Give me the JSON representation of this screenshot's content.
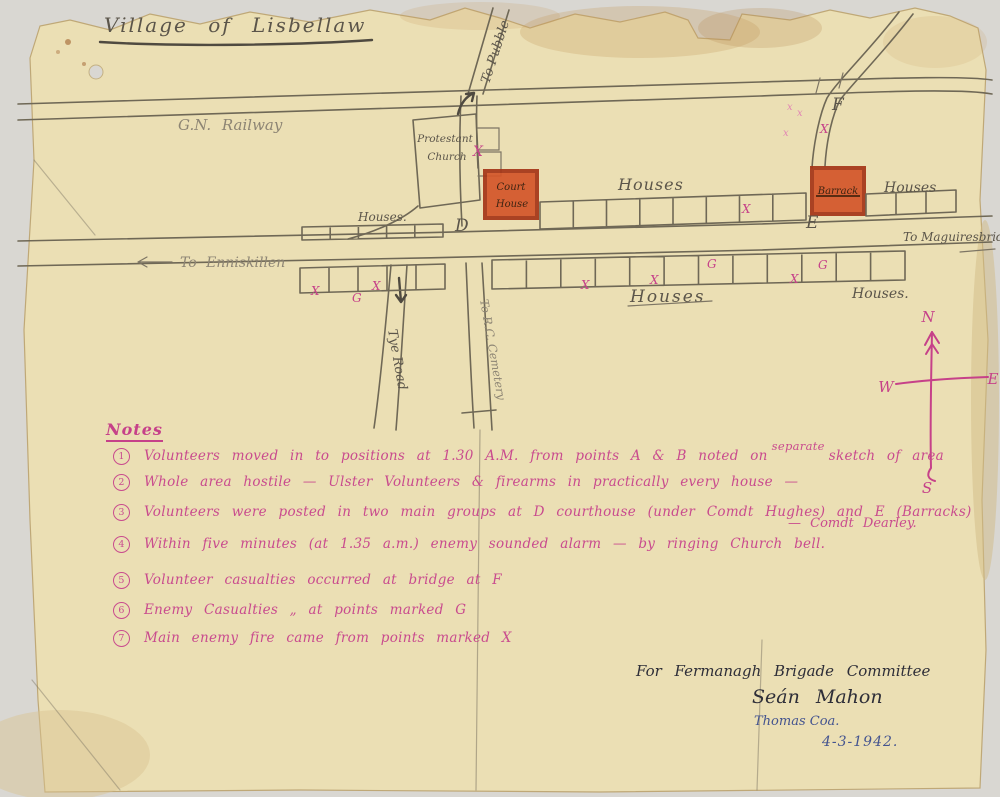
{
  "map": {
    "title": "Village of Lisbellaw",
    "labels": {
      "railway": "G.N. Railway",
      "road_north": "To Pubble",
      "road_west": "To Enniskillen",
      "road_east": "To Maguiresbridge",
      "road_south_west": "Tye Road",
      "road_south_east": "To R.C. Cemetery",
      "church_line1": "Protestant",
      "church_line2": "Church",
      "courthouse_line1": "Court",
      "courthouse_line2": "House",
      "barrack": "Barrack",
      "houses_top_mid": "Houses",
      "houses_top_right": "Houses",
      "houses_west": "Houses.",
      "houses_bottom_mid": "Houses",
      "houses_bottom_right": "Houses.",
      "point_d": "D",
      "point_e": "E",
      "point_f": "F",
      "compass_n": "N",
      "compass_s": "S",
      "compass_e": "E",
      "compass_w": "W",
      "mark_x": "X",
      "mark_x_small": "x",
      "mark_g": "G"
    },
    "colors": {
      "ink_pink": "#c64189",
      "crayon_red": "#d4562a",
      "ink_blue": "#44548f",
      "pencil": "#6f6856"
    }
  },
  "notes": {
    "heading": "Notes",
    "items": [
      {
        "num": "1",
        "text_a": "Volunteers moved in to positions at 1.30 A.M. from points A & B noted on",
        "insert": "separate",
        "text_b": "sketch of area"
      },
      {
        "num": "2",
        "text": "Whole area hostile — Ulster Volunteers & firearms in practically every house —"
      },
      {
        "num": "3",
        "text": "Volunteers were posted in two main groups at D courthouse (under Comdt Hughes) and E (Barracks)",
        "insert": "— Comdt Dearley."
      },
      {
        "num": "4",
        "text": "Within five minutes (at 1.35 a.m.) enemy sounded alarm — by ringing Church bell."
      },
      {
        "num": "5",
        "text": "Volunteer casualties occurred at bridge at  F"
      },
      {
        "num": "6",
        "text": "Enemy Casualties „ at points marked G"
      },
      {
        "num": "7",
        "text": "Main enemy fire came from points marked X"
      }
    ]
  },
  "signature": {
    "line1": "For Fermanagh Brigade Committee",
    "line2": "Seán Mahon",
    "line3": "Thomas Coa.",
    "line4": "4-3-1942."
  }
}
